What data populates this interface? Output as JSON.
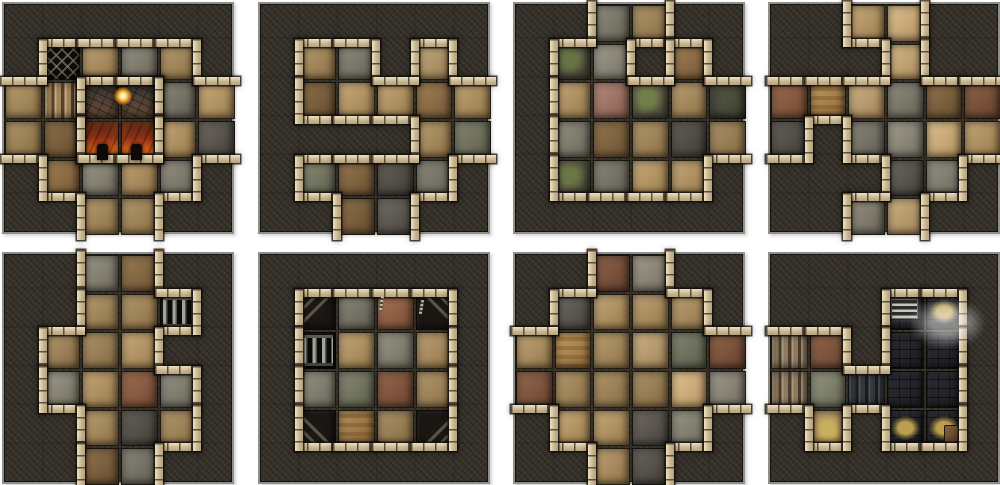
{
  "sheet": {
    "width": 1000,
    "height": 485,
    "background": "#ffffff",
    "tile_size": 232,
    "grid_cells": 6,
    "tile_origins_x": [
      2,
      258,
      513,
      768
    ],
    "tile_origins_y": [
      2,
      252
    ]
  },
  "palette": {
    "rock": "#37322a",
    "wall_light": "#eee2c2",
    "wall_mid": "#c9b793",
    "grout": "#15110c",
    "lava": "#cf5a1c",
    "torch_glow": "#f5bb3a",
    "dark_room": "#24262b",
    "hay": "#c3a552",
    "bars": "#a3a39a"
  },
  "floor_colors": {
    "t": [
      "#bca073",
      "#8f7347"
    ],
    "T": [
      "#d2b888",
      "#a8875a"
    ],
    "b": [
      "#9a7a50",
      "#6f5435"
    ],
    "B": [
      "#9c6b4e",
      "#6e4733"
    ],
    "g": [
      "#969284",
      "#6b675a"
    ],
    "G": [
      "#8a8c76",
      "#5f614e"
    ],
    "d": [
      "#6b675f",
      "#433f38"
    ],
    "o": [
      "#c09a60",
      "#8f6c3c"
    ],
    "p": [
      "#b3887a",
      "#82584c"
    ],
    "m": [
      "#6d6a55",
      "#474538"
    ],
    "c": [
      "#55554a",
      "#2e2e26"
    ]
  },
  "legend": {
    ".": "solid-rock",
    "t": "tan-stone-floor",
    "T": "light-tan-floor",
    "b": "brown-floor",
    "B": "red-brown-floor",
    "g": "gray-floor",
    "G": "gray-green-floor",
    "d": "dark-gray-floor",
    "o": "banded-orange-floor",
    "p": "pink-stone-floor",
    "m": "mossy-floor",
    "c": "dark-cobble-floor",
    "1": "lattice-grate-pit",
    "2": "stairs",
    "3": "scorched-floor",
    "4": "lava-floor",
    "5": "portcullis-cell",
    "6": "barred-grate-cell",
    "7": "corner-chevron-steps",
    "8": "dark-cellar-floor",
    "9": "vent-grate",
    "h": "hay-on-dark-floor",
    "x": "hay-and-crate",
    "H": "hay-on-tan-floor",
    "s": "dark-steps-passage",
    "S": "stone-stairs"
  },
  "tiles": [
    {
      "name": "tile-furnace-room",
      "col": 0,
      "row": 0,
      "grid": [
        "......",
        ".1tgt.",
        "t233gt",
        "tb44td",
        ".bgtg.",
        "..tt.."
      ],
      "fire_zone": [
        "3",
        "4"
      ],
      "decor": [
        {
          "type": "torch",
          "cx": 3.0,
          "cy": 2.3
        },
        {
          "type": "door",
          "cx": 2.55,
          "cy": 3.78
        },
        {
          "type": "door",
          "cx": 3.45,
          "cy": 3.78
        }
      ]
    },
    {
      "name": "tile-winding-corridors",
      "col": 1,
      "row": 0,
      "grid": [
        "......",
        ".tg.T.",
        ".bttbt",
        "....tG",
        ".Gbdg.",
        "..bd.."
      ],
      "decor": []
    },
    {
      "name": "tile-overgrown-hall",
      "col": 2,
      "row": 0,
      "grid": [
        "..gt..",
        ".mg.b.",
        ".tpmtc",
        ".gbtdt",
        ".mgtt.",
        "......"
      ],
      "decor": []
    },
    {
      "name": "tile-crossroads",
      "col": 3,
      "row": 0,
      "grid": [
        "..tT..",
        "...T..",
        "BoTgbB",
        "d.ggTt",
        "...dg.",
        "..gT.."
      ],
      "decor": []
    },
    {
      "name": "tile-barred-cell-corridor",
      "col": 0,
      "row": 1,
      "grid": [
        "..gb..",
        "..tt5.",
        ".ttt..",
        ".gtBg.",
        "..tdt.",
        "..bg.."
      ],
      "decor": []
    },
    {
      "name": "tile-sealed-prison-room",
      "col": 1,
      "row": 1,
      "grid": [
        "......",
        ".7gB7.",
        ".6tgt.",
        ".gGBt.",
        ".7ot7.",
        "......"
      ],
      "decor": [
        {
          "type": "chain",
          "cx": 3.25,
          "cy": 1.25
        },
        {
          "type": "chain",
          "cx": 4.3,
          "cy": 1.35
        }
      ]
    },
    {
      "name": "tile-great-hall",
      "col": 2,
      "row": 1,
      "grid": [
        "..Bg..",
        ".dttt.",
        "totTGB",
        "BtttTg",
        ".ttdg.",
        "..td.."
      ],
      "decor": []
    },
    {
      "name": "tile-dark-cellar",
      "col": 3,
      "row": 1,
      "grid": [
        "......",
        "...9h.",
        "SB.88.",
        "SGs88.",
        ".H.hx.",
        "......"
      ],
      "decor": [
        {
          "type": "mist",
          "cx": 3.75,
          "cy": 1.3
        }
      ]
    }
  ]
}
